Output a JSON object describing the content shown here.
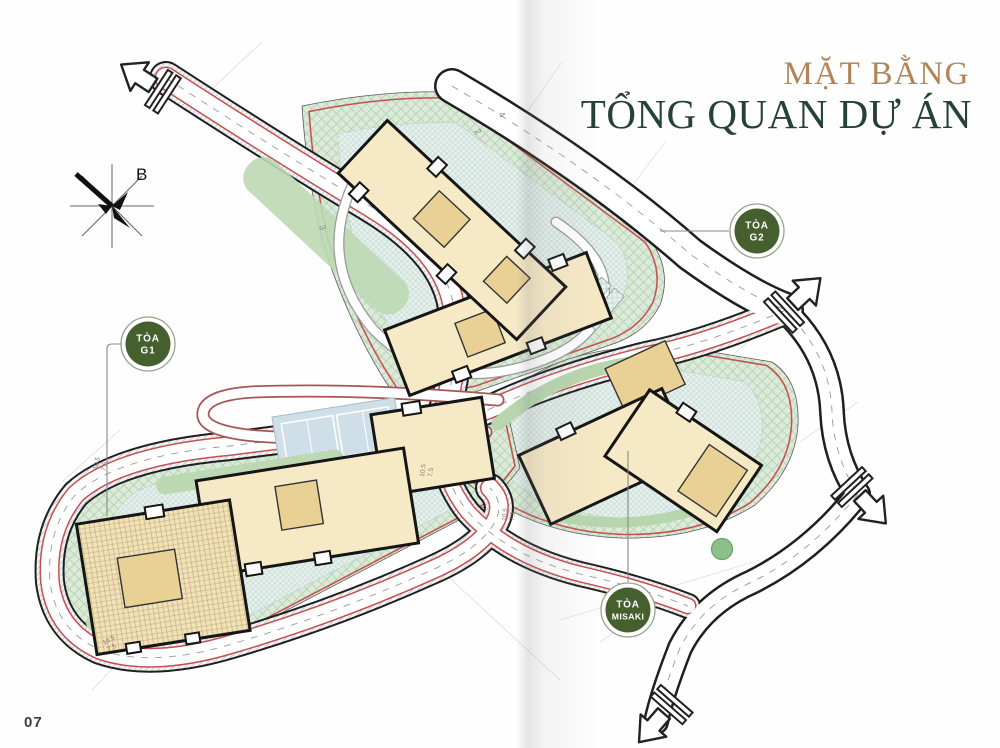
{
  "title": {
    "line1": "MẶT BẰNG",
    "line2": "TỔNG QUAN DỰ ÁN"
  },
  "page_number": "07",
  "compass": {
    "north_label": "B"
  },
  "badges": {
    "g2": {
      "line1": "TÒA",
      "line2": "G2"
    },
    "g1": {
      "line1": "TÒA",
      "line2": "G1"
    },
    "misaki": {
      "line1": "TÒA",
      "line2": "MISAKI"
    }
  },
  "dimension_labels": {
    "p1a": "10.5",
    "p1b": "7.5",
    "p2a": "10.5",
    "p2b": "7.5",
    "p3a": "10.5",
    "p3b": "7.5",
    "p4a": "10.5",
    "p4b": "7.5",
    "n1": "2",
    "n2": "4",
    "n3": "3"
  },
  "colors": {
    "title_gold": "#b28457",
    "title_green": "#264235",
    "badge_green": "#455f2e",
    "boundary_red": "#c84f4f",
    "landscape_green": "#dcead8",
    "paving_teal": "#e7f0ec",
    "building_fill": "#f6e9c5",
    "building_core": "#e9d196"
  }
}
